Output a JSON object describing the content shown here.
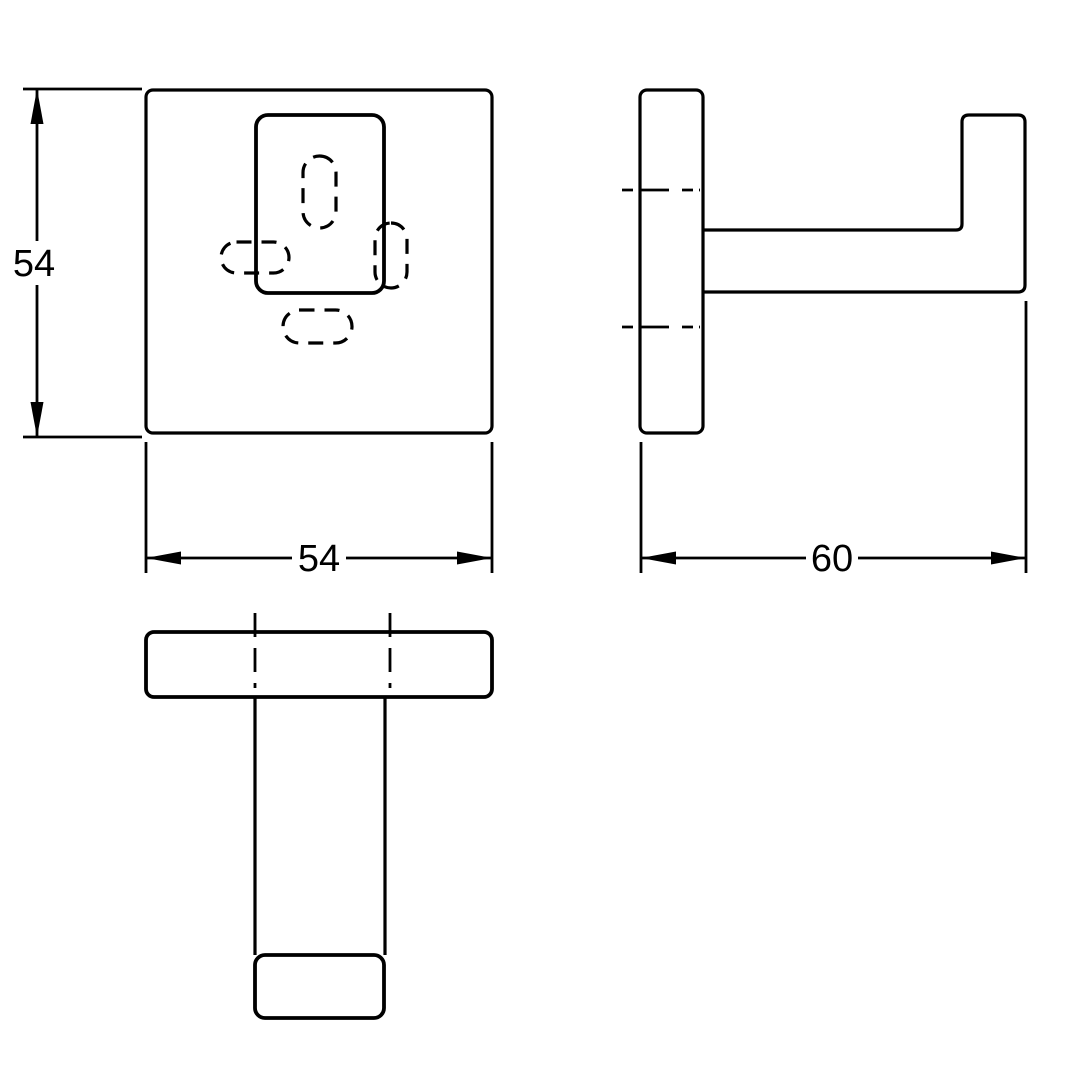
{
  "drawing": {
    "type": "technical-orthographic-views",
    "colors": {
      "line": "#000000",
      "background": "#ffffff"
    },
    "dimensions": {
      "front_height": {
        "label": "54"
      },
      "front_width": {
        "label": "54"
      },
      "side_depth": {
        "label": "60"
      }
    }
  }
}
